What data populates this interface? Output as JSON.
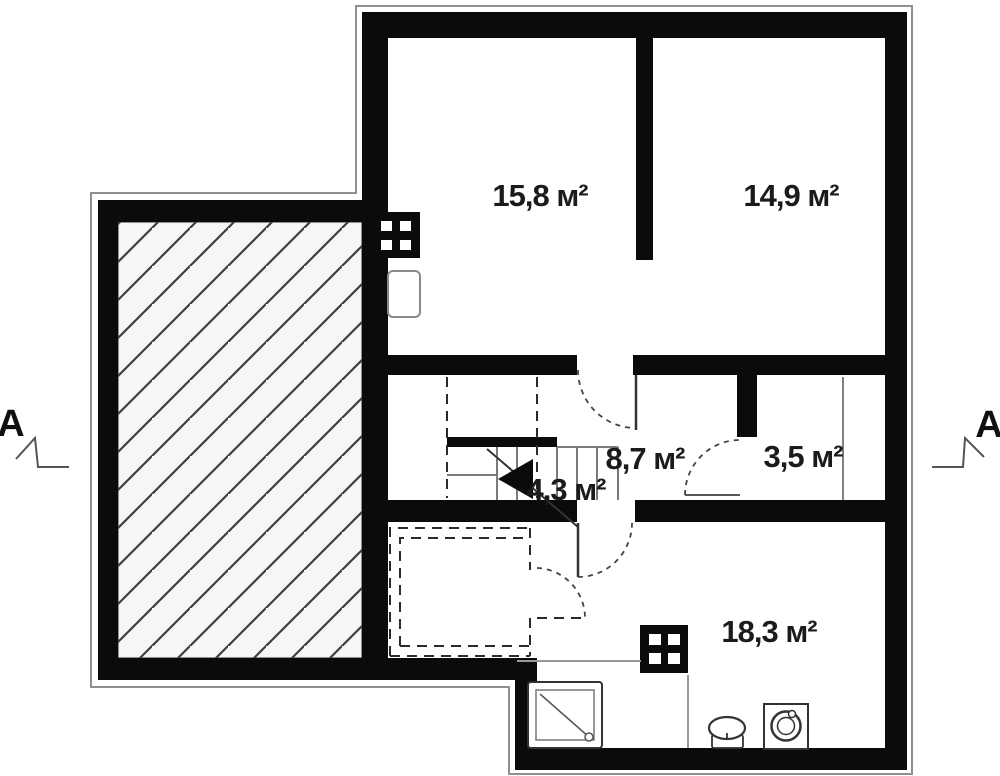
{
  "plan": {
    "title": "floor-plan",
    "rooms": [
      {
        "id": "bedroom-1",
        "area_label": "15,8 м²"
      },
      {
        "id": "bedroom-2",
        "area_label": "14,9 м²"
      },
      {
        "id": "hall",
        "area_label": "8,7 м²"
      },
      {
        "id": "closet",
        "area_label": "3,5 м²"
      },
      {
        "id": "stair-space",
        "area_label": "4,3 м²"
      },
      {
        "id": "living-bath",
        "area_label": "18,3 м²"
      }
    ],
    "markers": {
      "left": "A",
      "right": "A"
    },
    "colors": {
      "wall": "#0b0b0b",
      "background": "#ffffff",
      "terrace_fill": "#f6f6f4",
      "hatch_line": "#3d3d3d",
      "contour": "#909090"
    },
    "symbols": [
      "terrace-hatched-area",
      "chimney-upper",
      "boiler",
      "winder-stairs",
      "direction-arrow",
      "chimney-lower",
      "shower-tray",
      "toilet",
      "washing-machine",
      "door-swing-arcs",
      "dashed-planned-partition",
      "section-cut-markers"
    ]
  }
}
